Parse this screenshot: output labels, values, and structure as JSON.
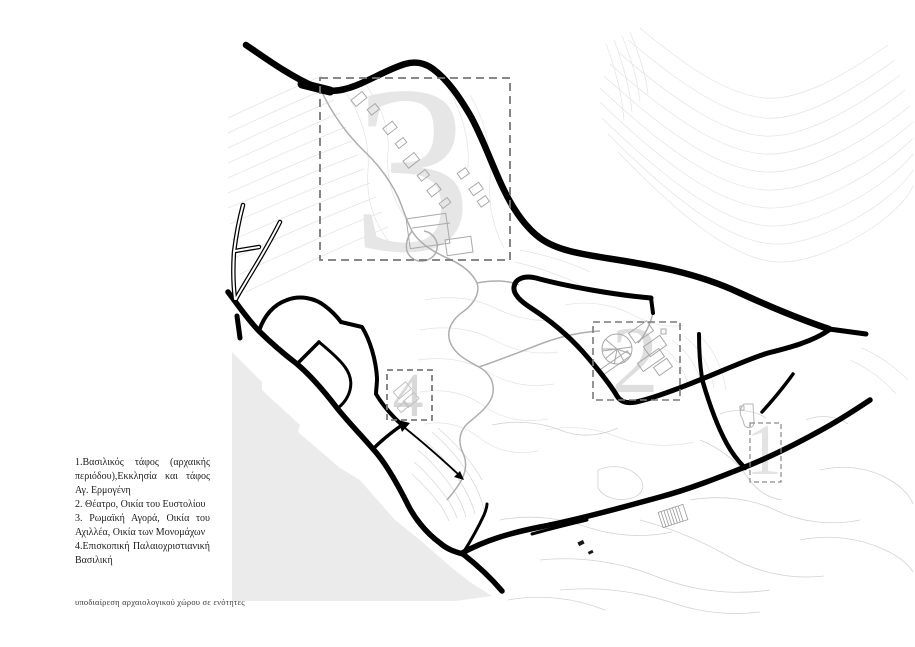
{
  "legend": {
    "items": [
      {
        "label": "1.Βασιλικός τάφος (αρχαικής περιόδου),Εκκλησία και τάφος Αγ. Ερμογένη"
      },
      {
        "label": "2. Θέατρο, Οικία του Ευστολίου"
      },
      {
        "label": "3. Ρωμαϊκή Αγορά, Οικία του Αχιλλέα, Οικία των Μονομάχων"
      },
      {
        "label": "4.Επισκοπική Παλαιοχριστιανική Βασιλική"
      }
    ]
  },
  "caption": {
    "text": "υποδιαίρεση αρχαιολογικού χώρου σε ενότητες"
  },
  "map": {
    "zones": [
      {
        "number": "1"
      },
      {
        "number": "2"
      },
      {
        "number": "3"
      },
      {
        "number": "4"
      }
    ],
    "colors": {
      "roads": "#000000",
      "contours": "#e3e3e3",
      "beach": "#ebebeb",
      "zone_numbers": "#e0e0e0",
      "dashed_boxes": "#7a7a7a"
    }
  }
}
